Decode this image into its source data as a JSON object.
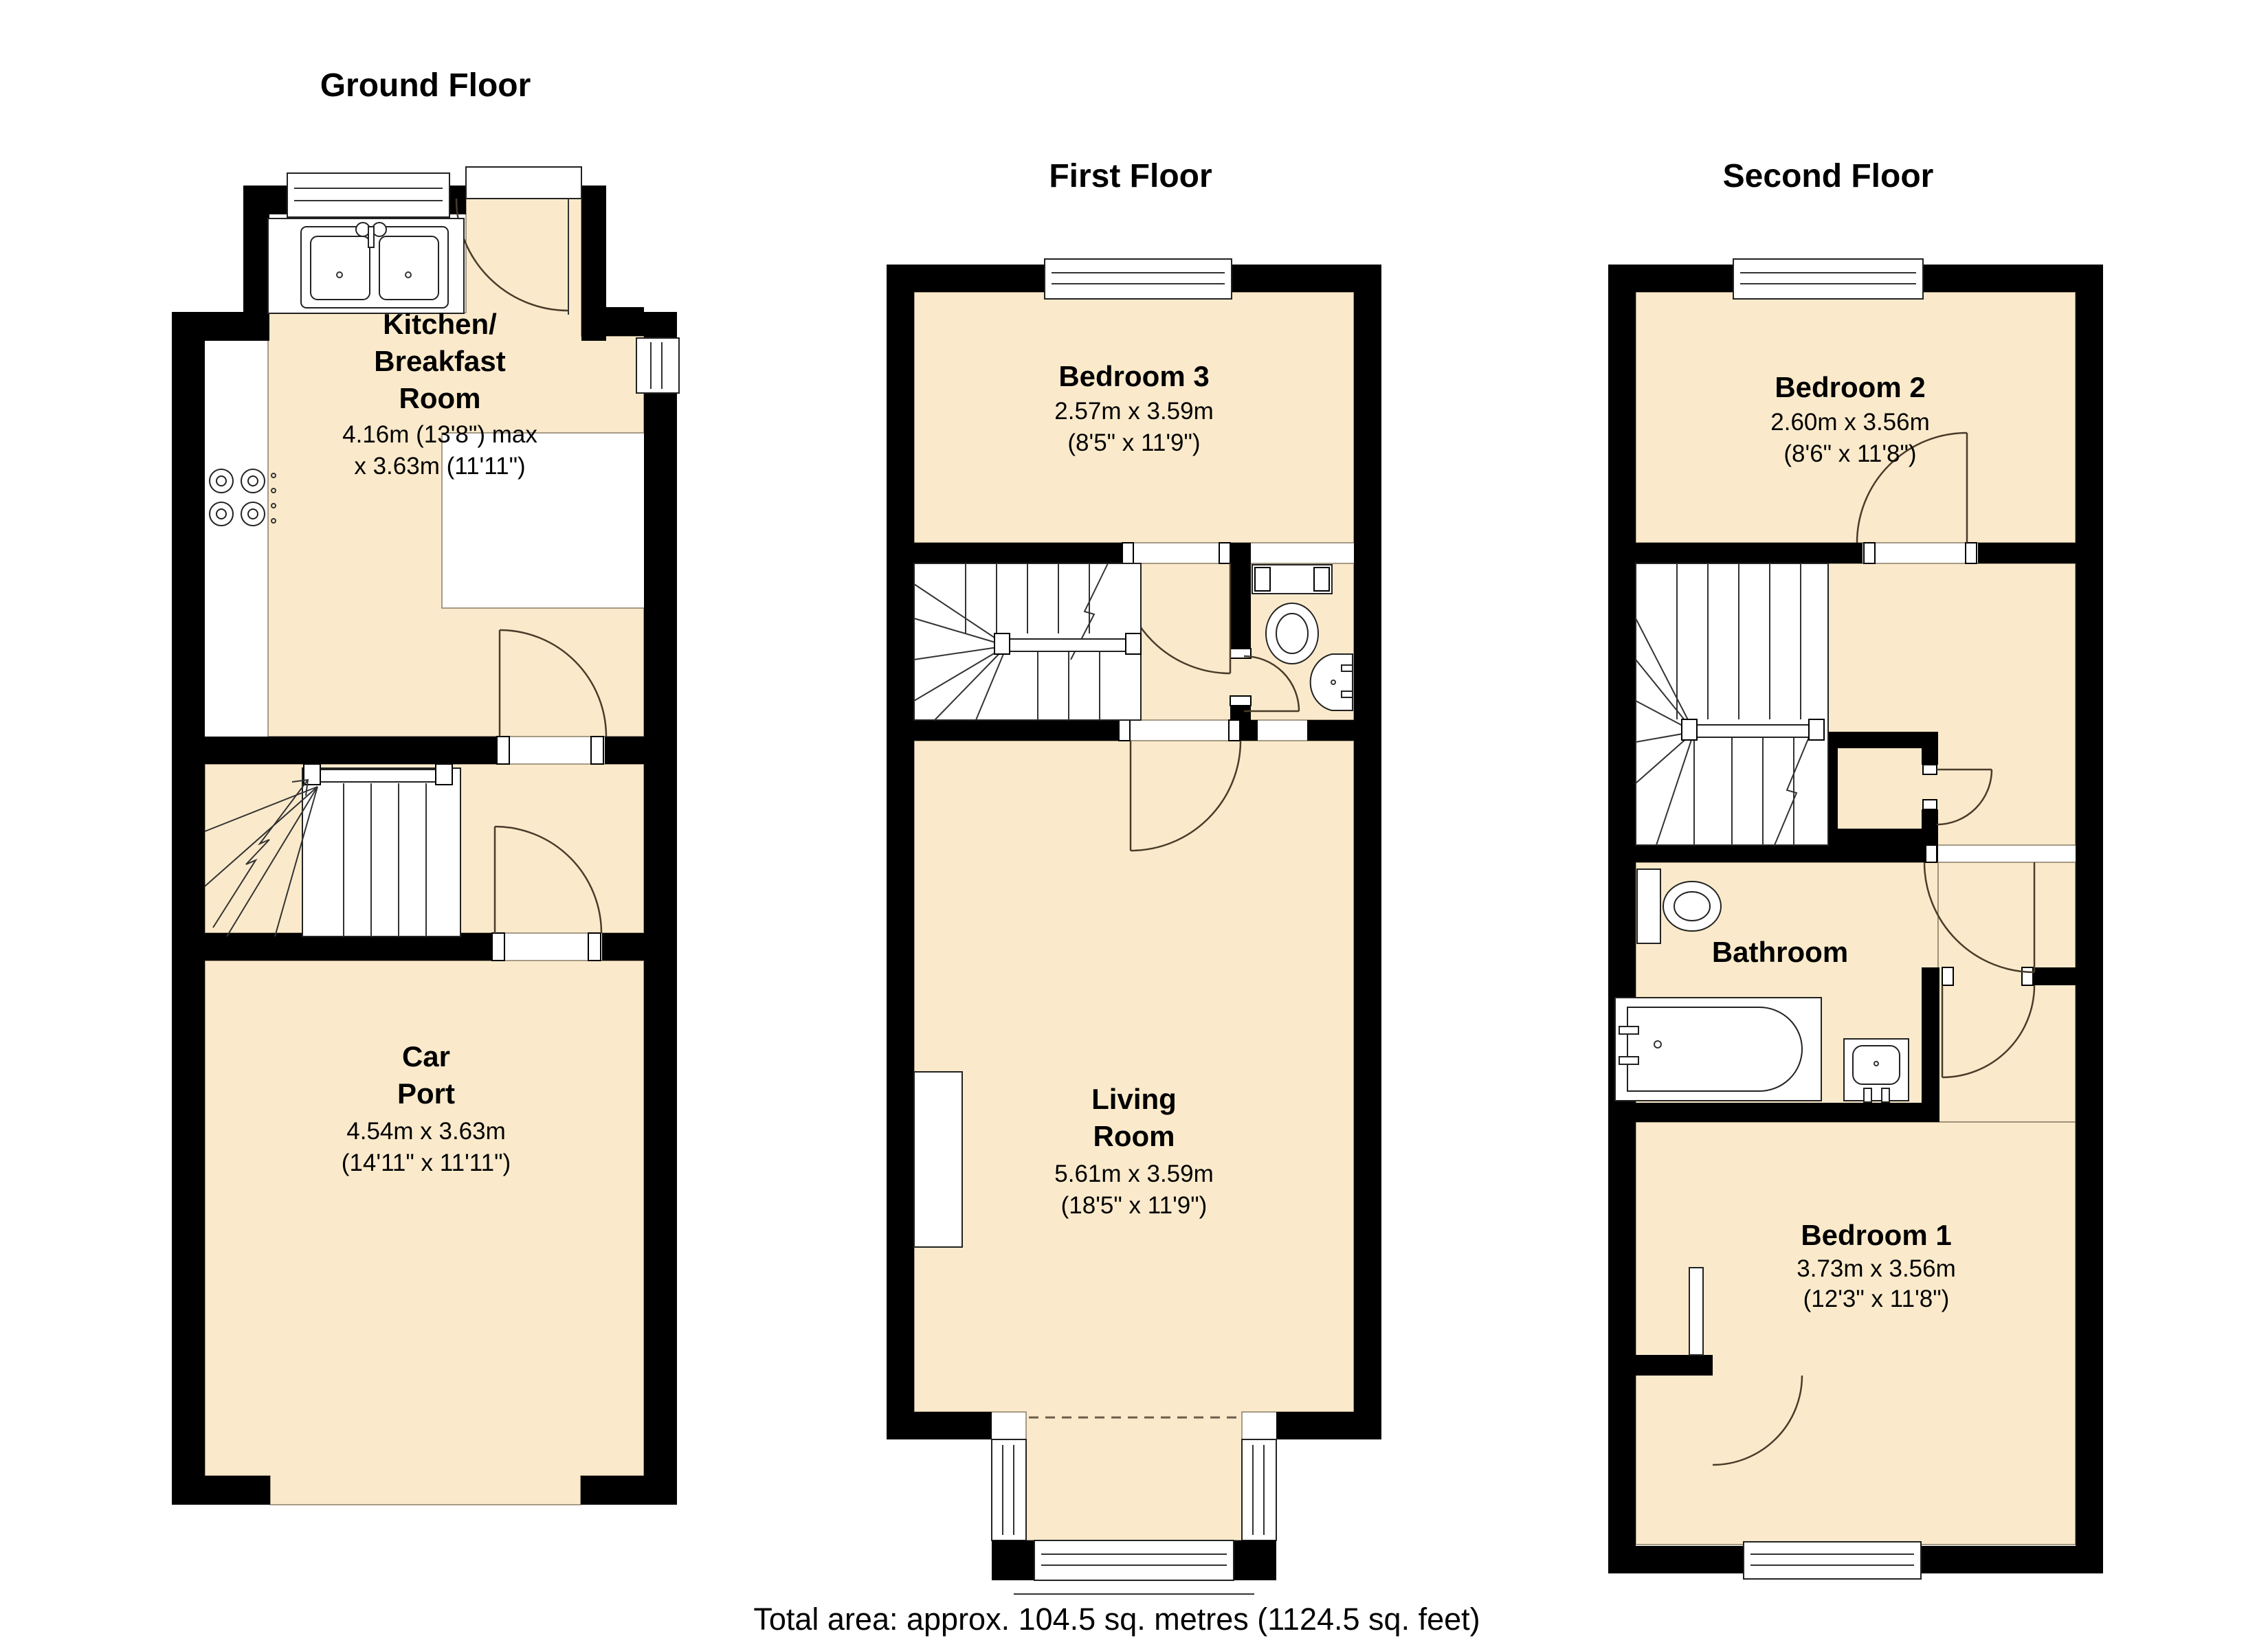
{
  "colors": {
    "room_fill": "#faeacb",
    "wall": "#000000",
    "line": "#333333",
    "background": "#ffffff"
  },
  "floors": [
    {
      "id": "ground",
      "title": "Ground Floor",
      "rooms": [
        {
          "id": "kitchen-breakfast-room",
          "name_lines": [
            "Kitchen/",
            "Breakfast",
            "Room"
          ],
          "dim_lines": [
            "4.16m (13'8\") max",
            "x 3.63m (11'11\")"
          ]
        },
        {
          "id": "car-port",
          "name_lines": [
            "Car",
            "Port"
          ],
          "dim_lines": [
            "4.54m x 3.63m",
            "(14'11\" x 11'11\")"
          ]
        }
      ]
    },
    {
      "id": "first",
      "title": "First Floor",
      "rooms": [
        {
          "id": "bedroom-3",
          "name_lines": [
            "Bedroom 3"
          ],
          "dim_lines": [
            "2.57m x 3.59m",
            "(8'5\" x 11'9\")"
          ]
        },
        {
          "id": "living-room",
          "name_lines": [
            "Living",
            "Room"
          ],
          "dim_lines": [
            "5.61m x 3.59m",
            "(18'5\" x 11'9\")"
          ]
        }
      ]
    },
    {
      "id": "second",
      "title": "Second Floor",
      "rooms": [
        {
          "id": "bedroom-2",
          "name_lines": [
            "Bedroom 2"
          ],
          "dim_lines": [
            "2.60m x 3.56m",
            "(8'6\" x 11'8\")"
          ]
        },
        {
          "id": "bathroom",
          "name_lines": [
            "Bathroom"
          ],
          "dim_lines": []
        },
        {
          "id": "bedroom-1",
          "name_lines": [
            "Bedroom 1"
          ],
          "dim_lines": [
            "3.73m x 3.56m",
            "(12'3\" x 11'8\")"
          ]
        }
      ]
    }
  ],
  "footer": {
    "total_area": "Total area: approx. 104.5 sq. metres (1124.5 sq. feet)"
  }
}
